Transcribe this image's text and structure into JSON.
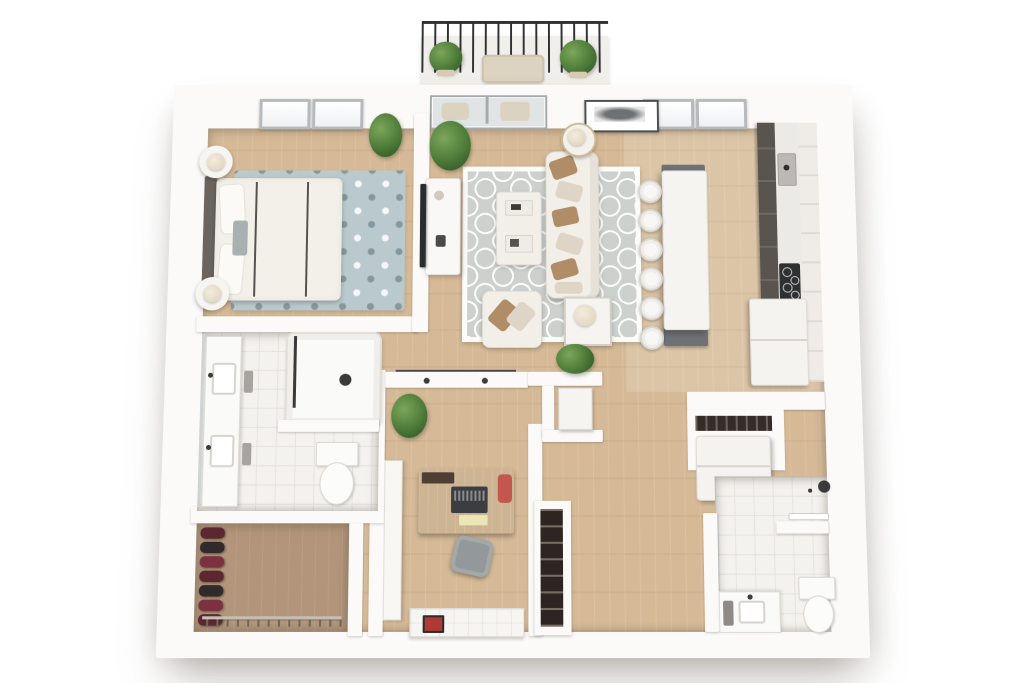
{
  "scene": {
    "type": "3d-floor-plan-rendering",
    "view": "top-down",
    "background": "#ffffff"
  },
  "palette": {
    "wall": "#fbfaf8",
    "wood": "#d6ba97",
    "wood_dark": "#b2957a",
    "tile": "#f4f2ee",
    "tile_line": "#e7e4df",
    "rug_blue": "#b9c9cd",
    "rug_gray": "#ccd1ce",
    "cabinet_dark": "#5a544f",
    "counter": "#eceae6",
    "island_base": "#6e7175",
    "upholstery": "#f2efe9",
    "pillow_brown": "#b08d66",
    "pillow_cream": "#ded5c6",
    "plant_light": "#7ca65a",
    "plant": "#4c7a38",
    "plant_dark": "#2f5423",
    "clothes_red": "#5d2731",
    "clothes_black": "#312a2b",
    "desk_wood": "#cdb493",
    "laptop": "#3c3d40",
    "accent_red": "#c2574f",
    "notepad": "#ece5b4",
    "chair_gray": "#93999b",
    "railing": "#2f3133",
    "tv": "#2b2c2e",
    "glass": "#e0e4e5",
    "lamp": "#ddd0b8",
    "cooktop": "#2f3032",
    "sketch": "#6d7173",
    "headboard": "#6b655e"
  },
  "counts": {
    "island_stools": 6,
    "closet_clothes_items": 7,
    "closet_hangers": 14,
    "bedroom_skylights": 2,
    "kitchen_skylights": 2,
    "balcony_planters": 2
  },
  "rooms": [
    {
      "name": "balcony"
    },
    {
      "name": "bedroom"
    },
    {
      "name": "living-room"
    },
    {
      "name": "kitchen"
    },
    {
      "name": "bathroom"
    },
    {
      "name": "walk-in-closet"
    },
    {
      "name": "office"
    },
    {
      "name": "hallway"
    },
    {
      "name": "laundry-closet"
    },
    {
      "name": "second-bathroom"
    }
  ]
}
